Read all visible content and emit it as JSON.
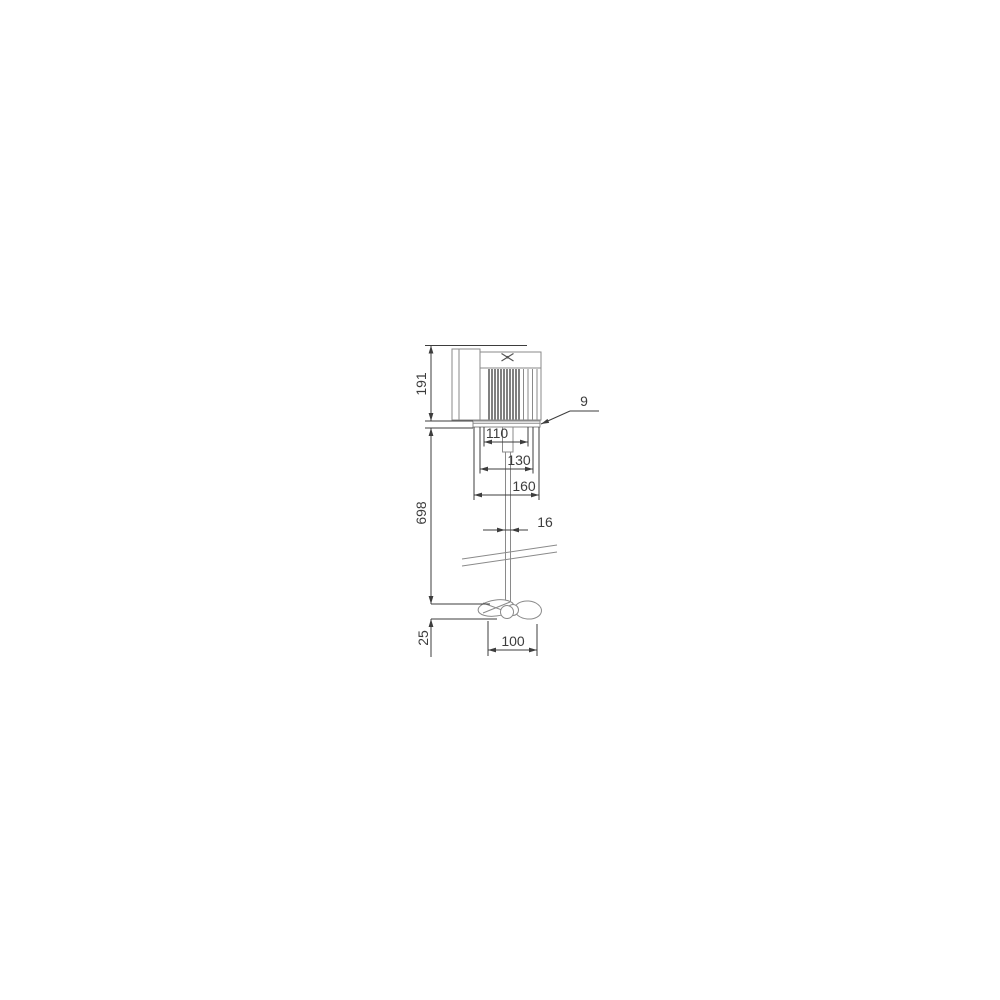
{
  "drawing": {
    "labels": {
      "motor_height": "191",
      "plate_thickness": "9",
      "hub_spacing": "110",
      "bracket_width": "130",
      "plate_width": "160",
      "shaft_length": "698",
      "shaft_diameter": "16",
      "propeller_offset": "25",
      "propeller_diameter": "100"
    },
    "icons": {
      "brand": "crossed-propeller-icon"
    },
    "colors": {
      "background": "#ffffff",
      "geometry": "#8a8a8a",
      "fins": "#4a4a4a",
      "dimension": "#3d3d3d",
      "text": "#3d3d3d"
    }
  }
}
